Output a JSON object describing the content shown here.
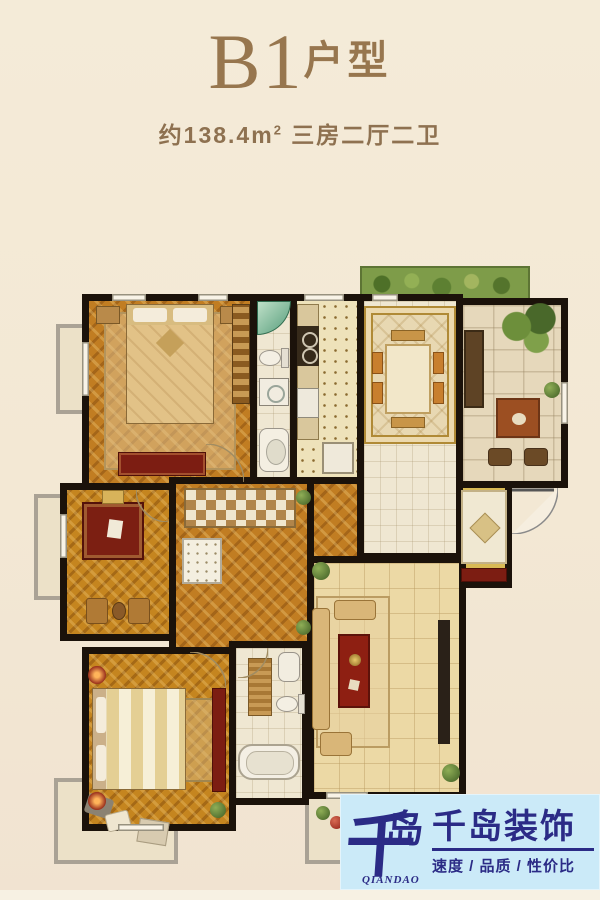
{
  "header": {
    "title_main": "B1",
    "title_suffix": "户型",
    "area_text": "约138.4m",
    "area_sup": "2",
    "layout_text": " 三房二厅二卫"
  },
  "logo": {
    "mark_char_1": "千",
    "mark_char_2": "岛",
    "mark_latin": "QIANDAO",
    "company_name": "千岛装饰",
    "tagline": "速度 / 品质 / 性价比"
  },
  "colors": {
    "page_background": "#f3e8d4",
    "title_brown": "#97764e",
    "wall_black": "#1b120a",
    "wood_floor": "#c17d22",
    "living_tile": "#ecd9a5",
    "accent_red": "#8e2016",
    "shower_green": "#569d7b",
    "logo_background": "#cbeaf8",
    "logo_navy": "#2b2b86"
  }
}
